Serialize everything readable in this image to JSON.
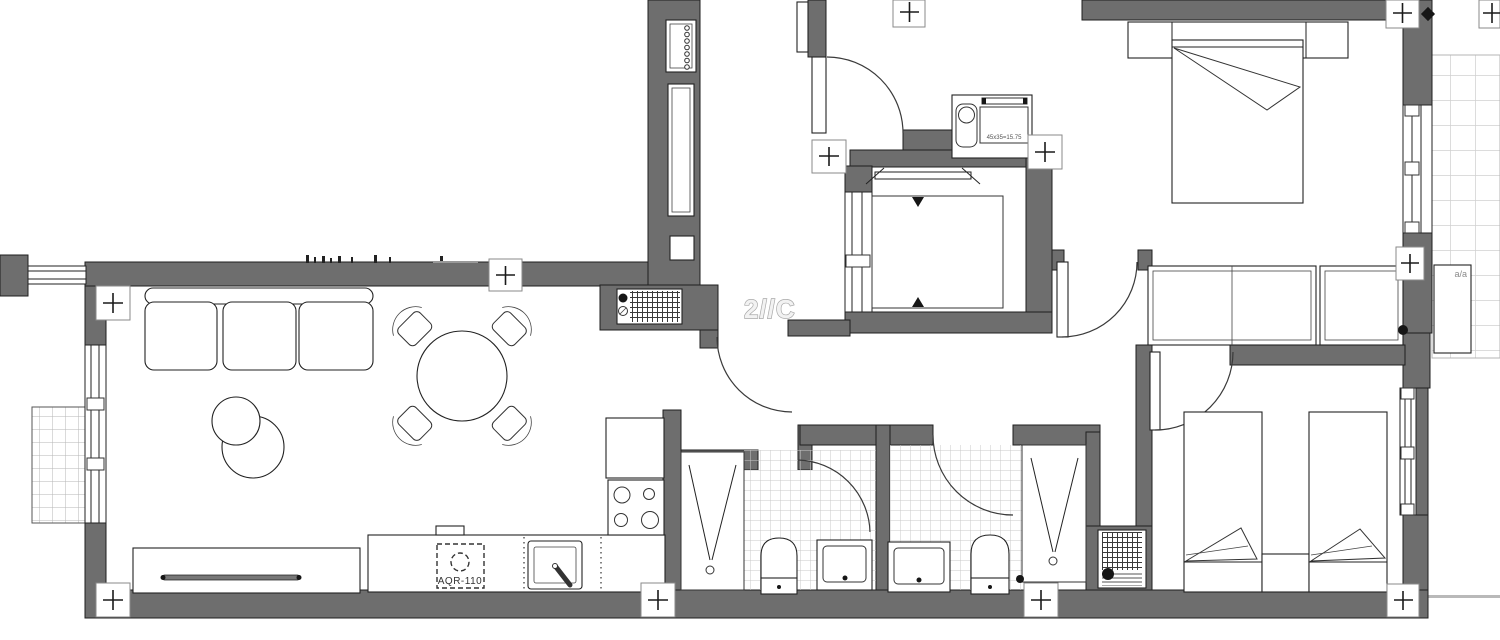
{
  "plan": {
    "unit_label": "2//C",
    "shaft_dimension": "45x35=15.75",
    "appliance_label": "AQR-110",
    "ac_label": "a/a"
  },
  "colors": {
    "paper": "#ffffff",
    "wall": "#6e6e6e",
    "line": "#1f1f1f",
    "tile_grid": "#c8c8c8",
    "terrace_grid": "#d0d0d0"
  }
}
